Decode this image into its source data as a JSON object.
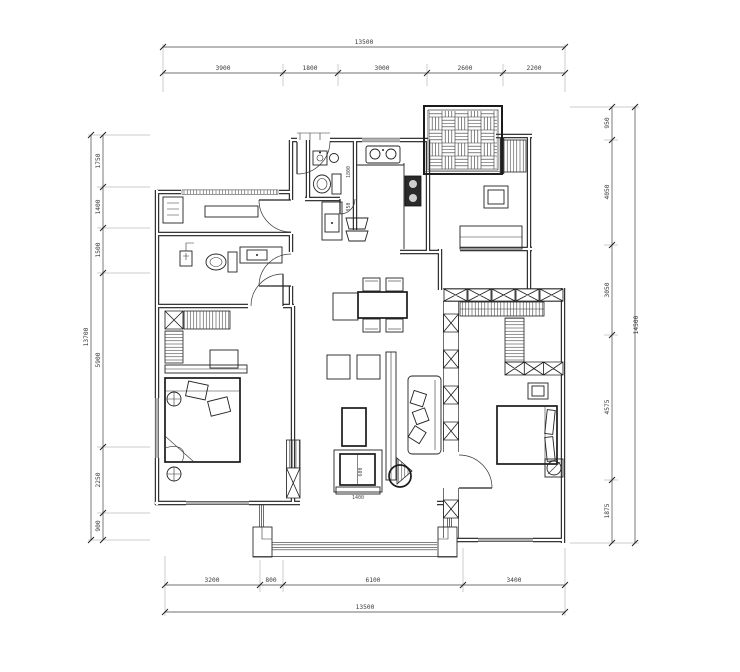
{
  "dimensions": {
    "top": {
      "total": "13500",
      "segments": [
        "3900",
        "1800",
        "3000",
        "2600",
        "2200"
      ]
    },
    "bottom": {
      "total": "13500",
      "segments": [
        "3200",
        "800",
        "6100",
        "3400"
      ]
    },
    "left": {
      "total": "13700",
      "segments": [
        "1750",
        "1400",
        "1500",
        "5900",
        "2250",
        "900"
      ]
    },
    "right": {
      "total": "14500",
      "segments": [
        "950",
        "4050",
        "3050",
        "4575",
        "1875"
      ]
    },
    "interior": {
      "bath_split_a": "1800",
      "bath_split_b": "850",
      "tv_width": "1400",
      "tv_depth": "600"
    }
  },
  "colors": {
    "background": "#ffffff",
    "line": "#1b1b1b",
    "dim_text": "#3a3a3a"
  },
  "furniture_icons": [
    "bed",
    "bed",
    "sofa",
    "dining-table",
    "dining-chair",
    "coffee-table",
    "tv-cabinet",
    "side-table",
    "floor-cushion",
    "toilet",
    "toilet",
    "washbasin",
    "washbasin",
    "kitchen-sink",
    "cooktop",
    "hall-cabinet",
    "bar-stool",
    "wardrobe",
    "wardrobe",
    "wardrobe",
    "desk",
    "shelf",
    "dresser",
    "nightstand",
    "bedside-lamp",
    "plant",
    "plant",
    "screen-partition",
    "shower"
  ]
}
